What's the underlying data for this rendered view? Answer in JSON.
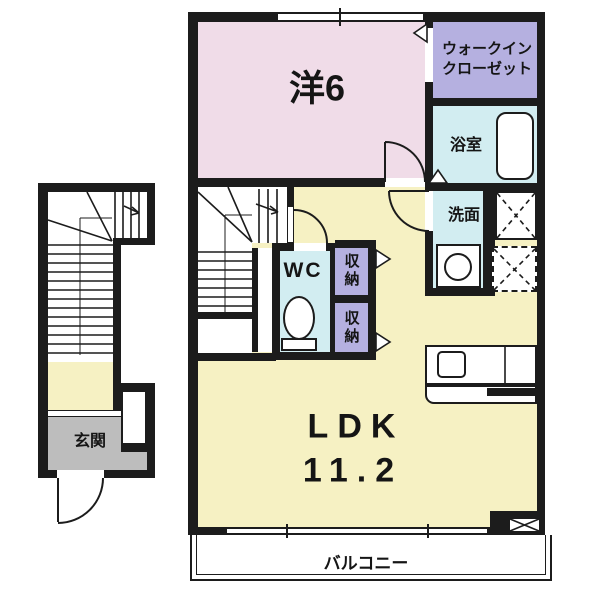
{
  "floorplan": {
    "rooms": {
      "western": {
        "label": "洋6"
      },
      "wic": {
        "line1": "ウォークイン",
        "line2": "クローゼット"
      },
      "bath": {
        "label": "浴室"
      },
      "wash": {
        "label": "洗面"
      },
      "wc": {
        "label": "WC"
      },
      "storage1": {
        "label": "収納"
      },
      "storage2": {
        "label": "収納"
      },
      "ldk": {
        "label": "LDK",
        "size": "11.2"
      },
      "entrance": {
        "label": "玄関"
      },
      "balcony": {
        "label": "バルコニー"
      }
    },
    "colors": {
      "wall": "#1c1c1c",
      "western": "#f0dce8",
      "closet": "#b5b0e0",
      "wet": "#d2edf1",
      "ldk": "#f6f1c3",
      "entrance_floor": "#bdbdbd",
      "line": "#1c1c1c"
    },
    "symbols": [
      "door-swing-arc",
      "door-leaf",
      "closet-x-mark",
      "dashed-x-mark",
      "stair-treads",
      "stair-up-arrow",
      "window-double-line",
      "washing-machine-circle",
      "toilet",
      "bathtub",
      "kitchen-sink",
      "door-triangle-marker"
    ]
  }
}
